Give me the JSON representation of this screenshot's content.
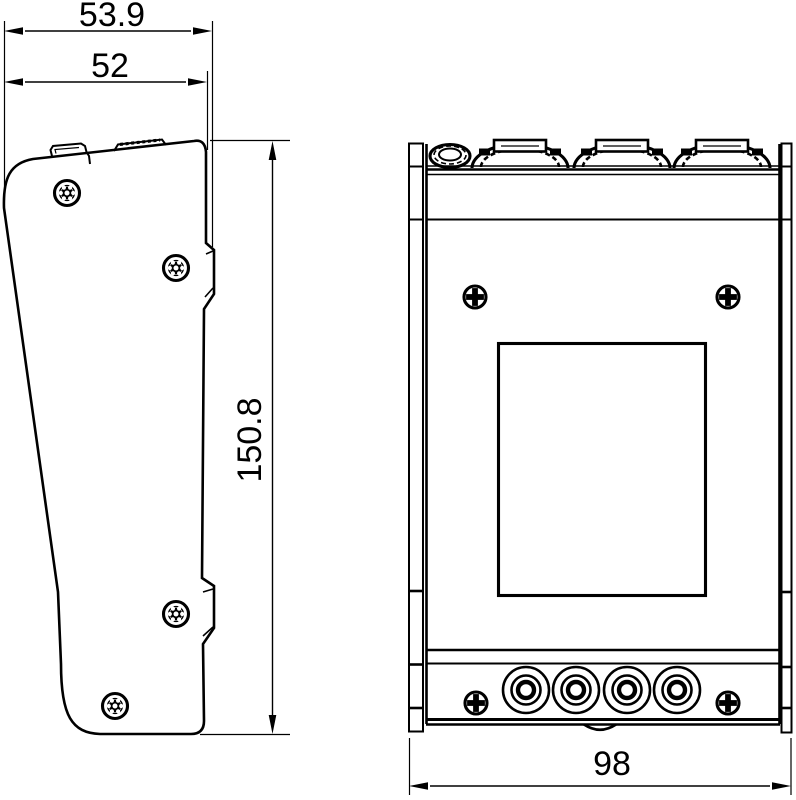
{
  "drawing": {
    "type": "technical-dimension-drawing",
    "views": [
      "side-view",
      "front-view"
    ]
  },
  "dimensions": {
    "side_width_outer": "53.9",
    "side_width_inner": "52",
    "height": "150.8",
    "front_width": "98"
  },
  "colors": {
    "line": "#000000",
    "background": "#ffffff"
  }
}
